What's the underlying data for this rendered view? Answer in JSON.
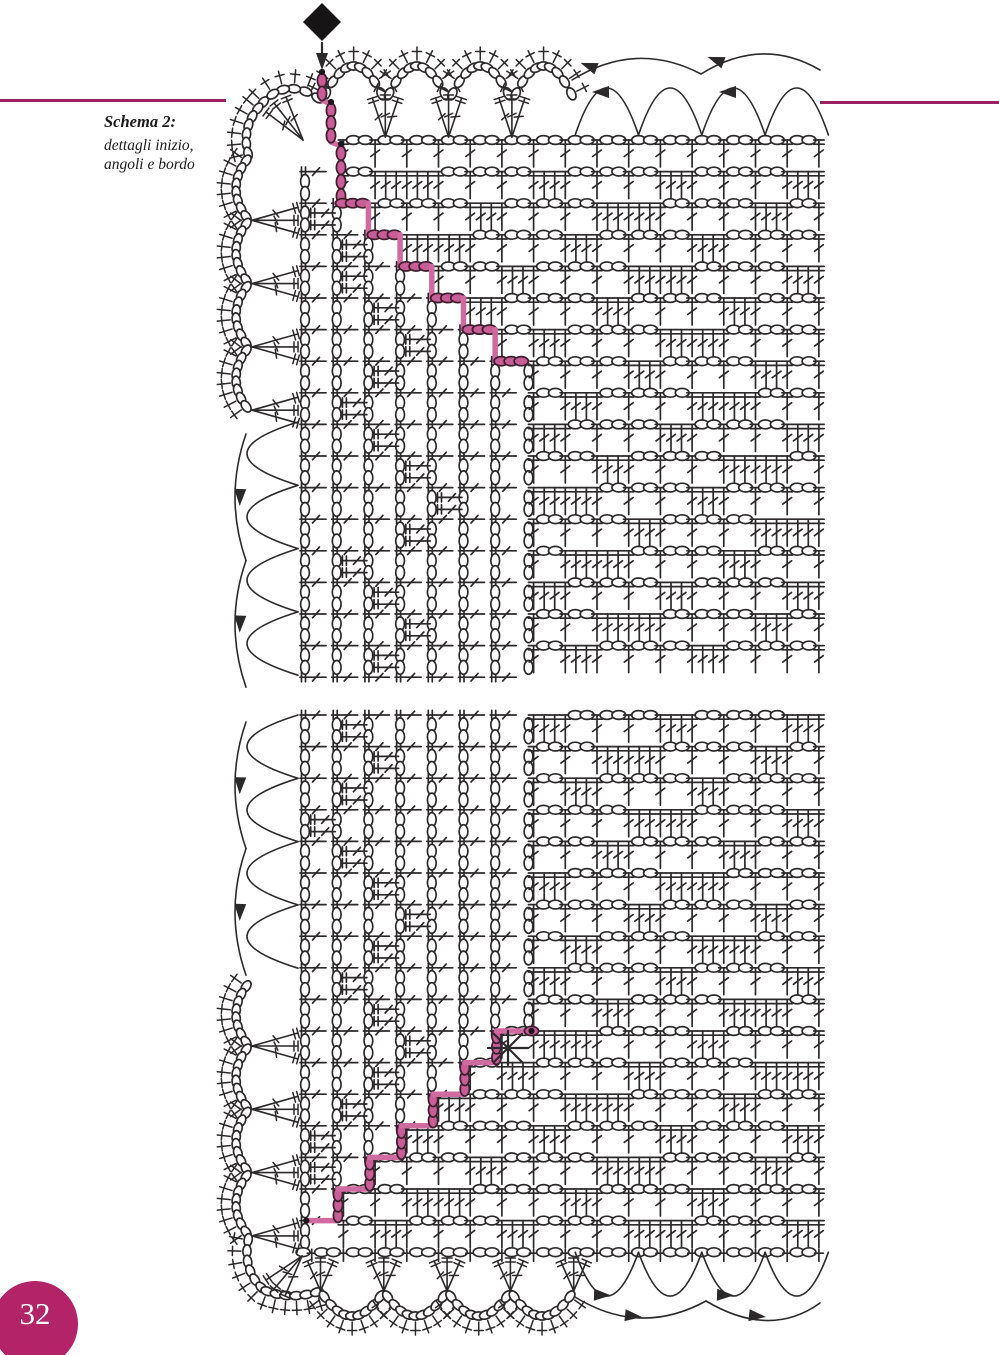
{
  "page": {
    "width": 999,
    "height": 1355,
    "background": "#ffffff",
    "number": "32",
    "badge_color": "#b32368",
    "badge_text_color": "#ffffff",
    "rule_color": "#9c2063"
  },
  "caption": {
    "title": "Schema 2:",
    "line1": "dettagli inizio,",
    "line2": "angoli e bordo",
    "color": "#1c1a1b"
  },
  "symbols": {
    "chain": "chain-stitch-oval",
    "double_crochet": "double-crochet-post",
    "single_crochet": "plus-tick",
    "shell": "3-double-crochet-fan",
    "direction_arrow": "work-direction-arrow",
    "start_marker": "black-diamond",
    "repeat_marker": "asterisk",
    "corner_line": "pink-step-line"
  },
  "diagram": {
    "ink": "#2c292a",
    "stroke_w": 1.7,
    "pink": {
      "line": "#cf6ba0",
      "fill": "#c85d97",
      "outline": "#3d1f2e",
      "dot": "#1f161c"
    },
    "cell_w": 31.7,
    "cell_h": 31.6,
    "grid_x0": 305,
    "post_x0": 311.7,
    "panels": [
      {
        "id": "top",
        "y0": 140,
        "n_rows": 17,
        "seed": 2,
        "band_max": [
          341,
          341,
          372.8,
          404.5,
          436.2,
          467.9,
          499.6,
          531.2,
          531.2,
          531.2,
          531.2,
          531.2,
          531.2,
          531.2,
          531.2,
          531.2,
          531.2
        ],
        "meander": [
          -1,
          1,
          1,
          2,
          2,
          3,
          4,
          3,
          2,
          3,
          4,
          5,
          4,
          2,
          3,
          4,
          3
        ],
        "pink_entry": [
          [
            322,
            74
          ],
          [
            322,
            100
          ],
          [
            331,
            104
          ],
          [
            331,
            142
          ],
          [
            341,
            146
          ],
          [
            341,
            203.2
          ]
        ],
        "pink_steps": {
          "x0": 336.7,
          "y0": 203.2,
          "n": 6,
          "dy": 31.6,
          "ovals": "h"
        },
        "pink_dots": [
          [
            322,
            72
          ],
          [
            331,
            102
          ],
          [
            341,
            144
          ]
        ]
      },
      {
        "id": "bottom",
        "y0": 715,
        "n_rows": 17,
        "seed": 7,
        "band_max": [
          531.2,
          531.2,
          531.2,
          531.2,
          531.2,
          531.2,
          531.2,
          531.2,
          531.2,
          531.2,
          499.6,
          467.9,
          436.2,
          404.5,
          372.8,
          341,
          318
        ],
        "meander": [
          2,
          3,
          2,
          1,
          2,
          3,
          4,
          3,
          2,
          3,
          4,
          3,
          2,
          1,
          1,
          -1,
          -1
        ],
        "pink_steps": {
          "x0": 306.3,
          "y0": 1220.6,
          "n": 7,
          "dy": -31.6,
          "ovals": "v"
        },
        "pink_terminal": [
          531.5,
          1031.0
        ],
        "pink_dots": [
          [
            306.3,
            1220.6
          ],
          [
            531.5,
            1031.0
          ]
        ],
        "edge_row_y": 1252.2
      }
    ],
    "markers": {
      "diamond": {
        "cx": 322,
        "cy": 22,
        "r": 19
      },
      "arrow_stem": {
        "x": 322,
        "y1": 43,
        "y2": 58
      },
      "asterisk": {
        "x": 508,
        "y": 1048,
        "r": 18
      }
    },
    "arrows": [
      [
        601,
        92,
        180
      ],
      [
        728,
        92,
        180
      ],
      [
        589,
        66,
        200
      ],
      [
        716,
        60,
        200
      ],
      [
        240,
        497,
        92
      ],
      [
        240,
        623.6,
        92
      ],
      [
        240,
        785.3,
        92
      ],
      [
        240,
        911.9,
        92
      ],
      [
        602,
        1295,
        2
      ],
      [
        725,
        1295,
        2
      ],
      [
        633,
        1316,
        6
      ],
      [
        757,
        1316,
        6
      ]
    ],
    "borders": {
      "top_scallops": {
        "x0": 322,
        "pitch": 63.3,
        "n": 4,
        "y": 102,
        "ctrl_y": 30,
        "fans_x": [
          385.3,
          448.6,
          511.9
        ],
        "fan_vy": 137
      },
      "corner_top": [
        [
          [
            322,
            101
          ],
          [
            286,
            74
          ],
          [
            260,
            106
          ]
        ],
        [
          [
            260,
            106
          ],
          [
            240,
            128
          ],
          [
            249,
            157
          ]
        ]
      ],
      "corner_top_fan": {
        "vx": 303,
        "vy": 140,
        "tips": [
          [
            266,
            112
          ],
          [
            274,
            103
          ],
          [
            286,
            97
          ]
        ]
      },
      "left_scallops_top": {
        "x": 249,
        "y0": 157,
        "pitch": 63.3,
        "n": 4,
        "ctrl_x": 223,
        "fans_y": [
          220.3,
          283.6,
          346.9,
          410.2
        ],
        "fan_vx": 252
      },
      "left_arcs_top": {
        "inner_x": 298,
        "y0": 422,
        "pitch": 63.3,
        "n": 4,
        "ctrl_x": 196,
        "outer_x": 246,
        "outer_y0": 434,
        "outer_span": 126.6,
        "outer_n": 2,
        "outer_ctrl_x": 224
      },
      "left_arcs_bottom": {
        "inner_x": 298,
        "y0": 715,
        "pitch": 63.3,
        "n": 4,
        "ctrl_x": 196,
        "outer_x": 246,
        "outer_y0": 722,
        "outer_span": 126.6,
        "outer_n": 2,
        "outer_ctrl_x": 224
      },
      "left_scallops_bottom": {
        "x": 249,
        "y0": 982.7,
        "pitch": 63.3,
        "n": 4,
        "ctrl_x": 223,
        "fans_y": [
          1046,
          1109.3,
          1172.6,
          1235.9
        ],
        "fan_vx": 252
      },
      "corner_bottom": [
        [
          [
            249,
            1235.9
          ],
          [
            241,
            1270
          ],
          [
            264,
            1290
          ]
        ],
        [
          [
            264,
            1290
          ],
          [
            290,
            1301
          ],
          [
            320.5,
            1291
          ]
        ]
      ],
      "corner_bottom_fan": {
        "vx": 302,
        "vy": 1256,
        "tips": [
          [
            266,
            1280
          ],
          [
            274,
            1289
          ],
          [
            285,
            1296
          ]
        ]
      },
      "bottom_scallops": {
        "x0": 320.5,
        "pitch": 63.3,
        "n": 4,
        "y": 1291,
        "ctrl_y": 1341,
        "fans_x": [
          320.5,
          383.8,
          447.1,
          510.4,
          573.7
        ],
        "fan_top": 1258
      },
      "right_arcs_top": {
        "x0": 575.2,
        "pitch": 63.3,
        "n": 4,
        "base_y": 135,
        "ctrl_y": 41,
        "outer": [
          [
            [
              572,
              80
            ],
            [
              636,
              40
            ],
            [
              701,
              74
            ]
          ],
          [
            [
              701,
              74
            ],
            [
              762,
              36
            ],
            [
              820,
              70
            ]
          ]
        ]
      },
      "right_arcs_bottom": {
        "x0": 575.2,
        "pitch": 63.3,
        "n": 4,
        "base_y": 1252.2,
        "ctrl_y": 1340,
        "outer": [
          [
            [
              575,
              1297
            ],
            [
              640,
              1337
            ],
            [
              706,
              1301
            ]
          ],
          [
            [
              706,
              1301
            ],
            [
              770,
              1339
            ],
            [
              820,
              1303
            ]
          ]
        ]
      }
    }
  }
}
